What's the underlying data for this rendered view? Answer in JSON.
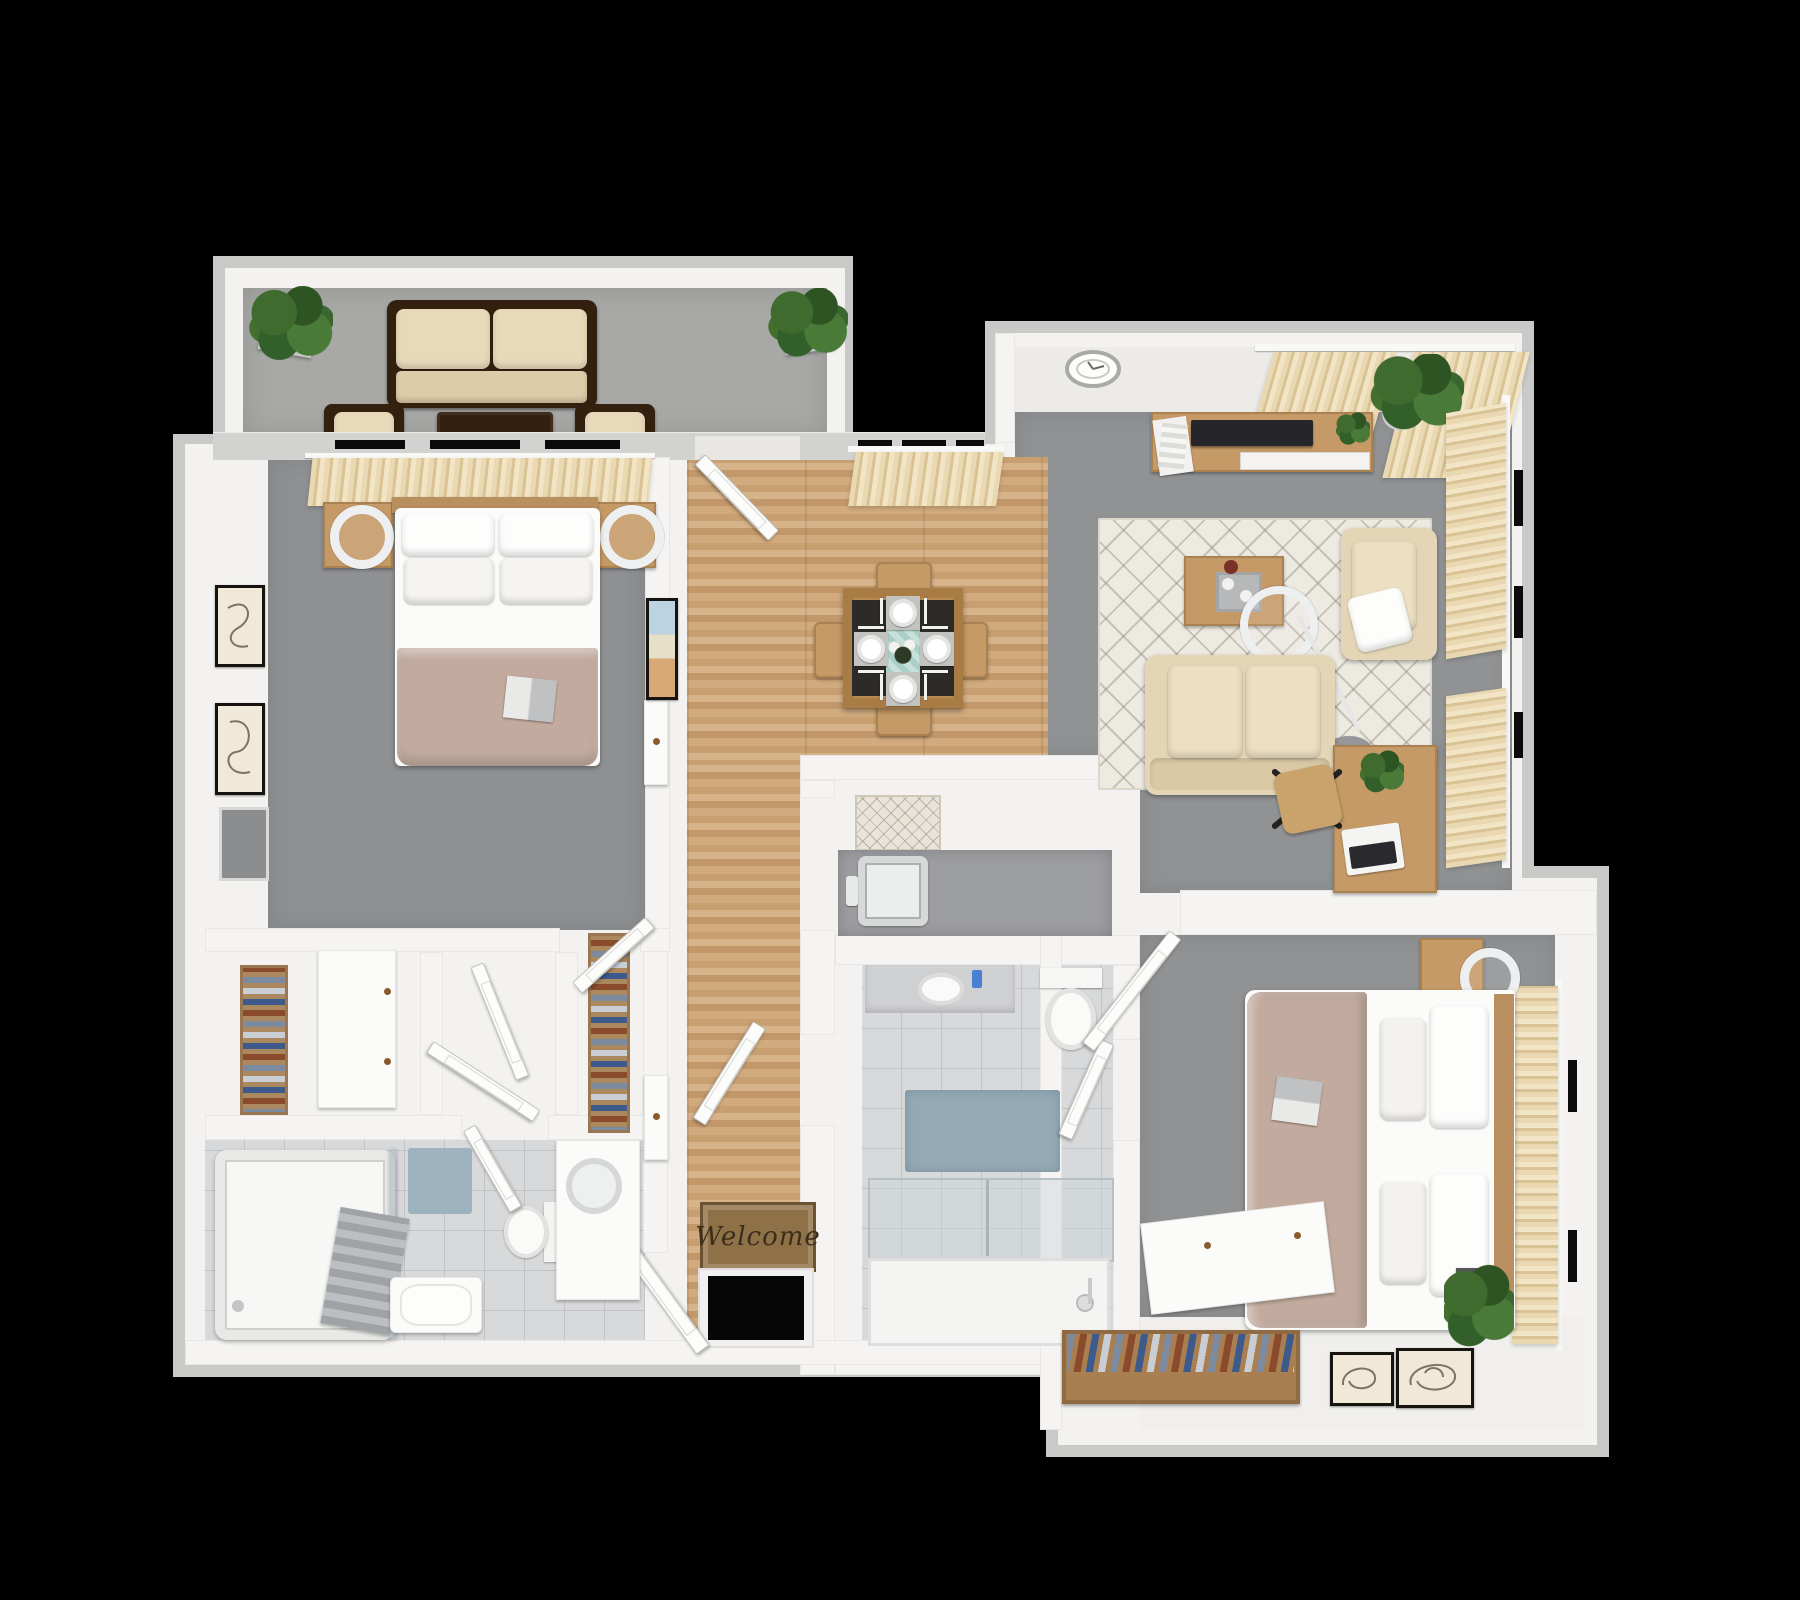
{
  "scene": {
    "type": "3D floor plan render, top-down view",
    "description": "Two-bedroom two-bath apartment with patio, central dining/hall, living room and laundry nook",
    "background_color": "#000000",
    "canvas": {
      "width": 1800,
      "height": 1600
    }
  },
  "entry": {
    "welcome_mat_text": "Welcome"
  },
  "palette": {
    "outer_wall": "#c9c9c7",
    "inner_wall": "#f5f4f2",
    "carpet_gray": "#8e9092",
    "patio_floor": "#a8a9a7",
    "wood_floor": "#cda77c",
    "furniture_wood": "#c59a66",
    "dark_wicker": "#33200f",
    "cushion_beige": "#e6d7b8",
    "coverlet_taupe": "#c2ab9e",
    "tile": "#d8d9db",
    "bath_mat_blue": "#93a9b6",
    "rug_cream": "#edeae2",
    "curtain_beige": "#e9d8b2",
    "plant_green": "#3f6b2f",
    "welcome_mat_brown": "#8f7148"
  },
  "rooms": [
    {
      "id": "patio",
      "label": "Patio / Balcony",
      "furniture": [
        "wicker loveseat with two beige cushions",
        "wicker coffee table",
        "two wicker armchairs with beige cushions",
        "two potted plants in white planters"
      ]
    },
    {
      "id": "bedroom-1",
      "label": "Bedroom 1 (top left)",
      "furniture": [
        "double bed with white linens and taupe coverlet",
        "open book on bed",
        "two wood nightstands",
        "two round white table lamps",
        "beige curtain panel behind headboard",
        "two framed abstract artworks",
        "gray wall panel TV",
        "white dresser with wood knobs",
        "shoe and linen shelving",
        "swing door to hallway"
      ]
    },
    {
      "id": "closet-corridor",
      "label": "Closet corridor",
      "furniture": [
        "linen closet with wood shelving and folded clothes",
        "two white closet doors",
        "framed artwork facing hallway",
        "two bifold closet doors"
      ]
    },
    {
      "id": "bathroom-1",
      "label": "Bathroom 1 (bottom left)",
      "furniture": [
        "bathtub with glass screen",
        "gray hanging towels",
        "white towel bench",
        "blue bath mat",
        "toilet",
        "vanity with round sink",
        "swing door"
      ]
    },
    {
      "id": "dining-area",
      "label": "Dining area",
      "furniture": [
        "square wood dining table",
        "four wood dining chairs",
        "four white place settings with cutlery",
        "teal table runner",
        "flower centerpiece",
        "window with beige curtains",
        "french door to patio"
      ]
    },
    {
      "id": "hallway-entry",
      "label": "Hallway / Entry",
      "furniture": [
        "wood plank flooring",
        "patterned runner rug",
        "Welcome door mat",
        "open front entry door"
      ]
    },
    {
      "id": "laundry-nook",
      "label": "Laundry nook",
      "furniture": [
        "utility sink set in gray counter"
      ]
    },
    {
      "id": "bathroom-2",
      "label": "Bathroom 2 (center)",
      "furniture": [
        "vanity with oval sink and blue soap bottle",
        "toilet",
        "blue-gray bath mat",
        "walk-in glass shower with tray and hand shower",
        "two swing doors"
      ]
    },
    {
      "id": "living-room",
      "label": "Living room (top right)",
      "furniture": [
        "wood TV console",
        "flat screen TV",
        "magazine stack",
        "small console plant",
        "round ceiling light clock",
        "large potted plant in white pot",
        "cream diamond-pattern area rug",
        "wood coffee table with decor tray",
        "arc floor lamp with round base",
        "beige loveseat sofa",
        "beige armchair with white throw pillow",
        "wood writing desk",
        "open laptop",
        "desk plant",
        "wood office chair with black star base",
        "top window with beige curtains",
        "two right-wall windows with beige curtains"
      ]
    },
    {
      "id": "bedroom-2",
      "label": "Bedroom 2 (bottom right)",
      "furniture": [
        "double bed with white linens and taupe coverlet",
        "magazine on bed",
        "two wood nightstands",
        "round white lamp",
        "white cone lamp",
        "beige curtain window behind headboard",
        "potted plant in dark pot",
        "two framed artworks along wall",
        "closet rod with hanging clothes",
        "tilted white closet panel",
        "swing entry door"
      ]
    }
  ]
}
